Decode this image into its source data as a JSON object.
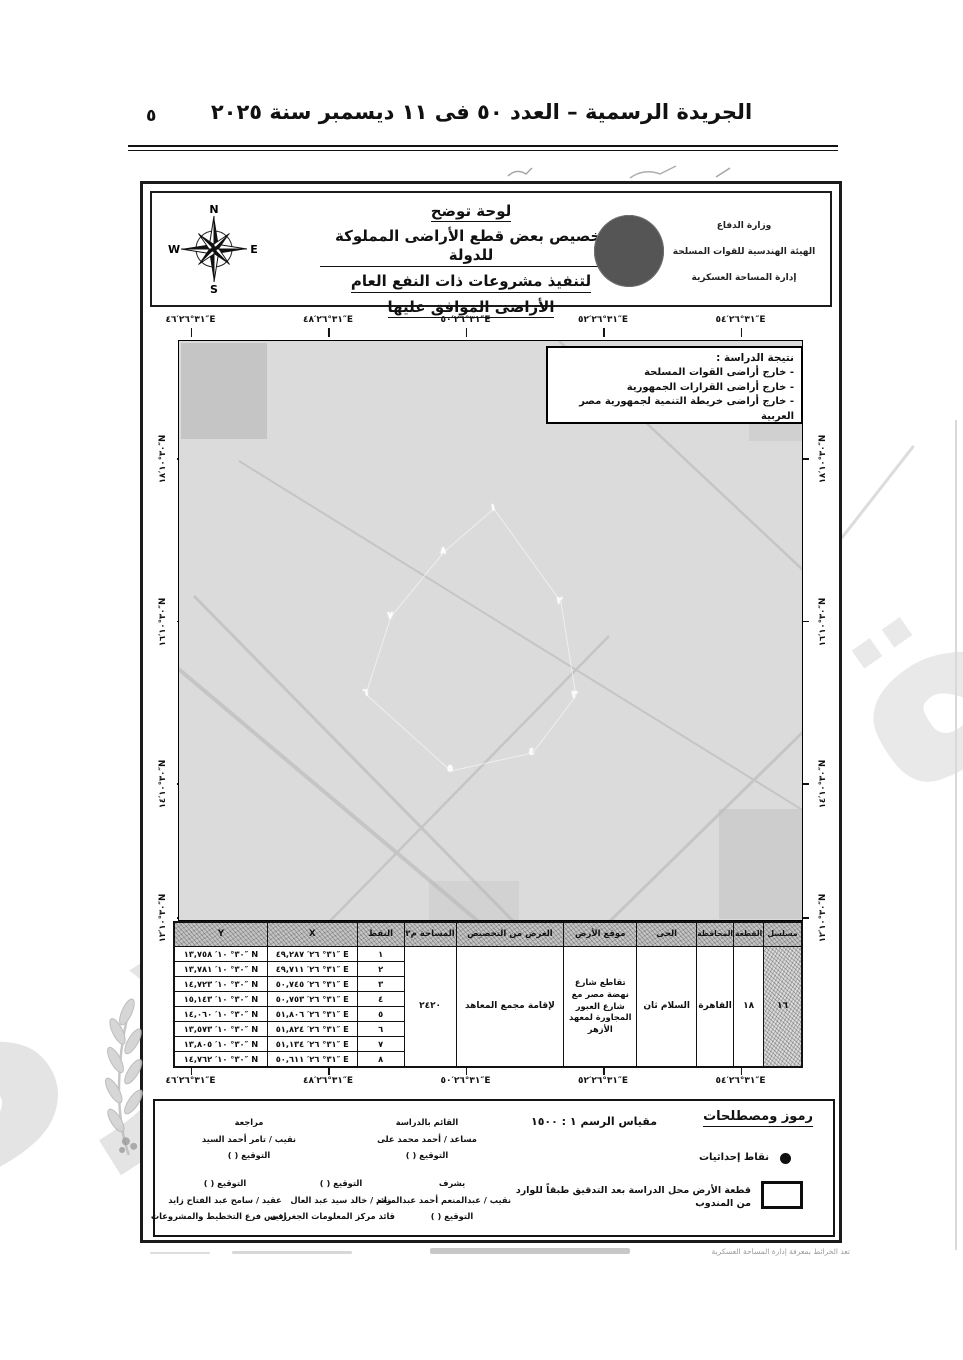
{
  "gazette": {
    "header_title": "الجريدة الرسمية – العدد ٥٠ فى ١١ ديسمبر سنة ٢٠٢٥",
    "page_number": "٥",
    "print_note": "تعد الخرائط بمعرفة إدارة المساحة العسكرية"
  },
  "plate": {
    "compass": {
      "n": "N",
      "s": "S",
      "e": "E",
      "w": "W"
    },
    "title_lines": [
      "لوحة توضح",
      "تخصيص بعض قطع الأراضى المملوكة للدولة",
      "لتنفيذ مشروعات ذات النفع العام",
      "الأراضى الموافق عليها"
    ],
    "agency_lines": [
      "وزارة الدفاع",
      "الهيئة الهندسية للقوات المسلحة",
      "إدارة المساحة العسكرية"
    ],
    "study_note": {
      "title": "نتيجة الدراسة :",
      "items": [
        {
          "text": "- خارج أراضى القوات المسلحة"
        },
        {
          "text": "- خارج أراضى القرارات الجمهورية"
        },
        {
          "text": "- خارج أراضى خريطة التنمية لجمهورية مصر العربية"
        }
      ]
    },
    "map": {
      "top_labels": [
        {
          "text": "٣١°٢٦′٤٦″E",
          "x": 2
        },
        {
          "text": "٣١°٢٦′٤٨″E",
          "x": 24
        },
        {
          "text": "٣١°٢٦′٥٠″E",
          "x": 46
        },
        {
          "text": "٣١°٢٦′٥٢″E",
          "x": 68
        },
        {
          "text": "٣١°٢٦′٥٤″E",
          "x": 90
        }
      ],
      "bottom_labels": [
        {
          "text": "٣١°٢٦′٤٦″E",
          "x": 2
        },
        {
          "text": "٣١°٢٦′٤٨″E",
          "x": 24
        },
        {
          "text": "٣١°٢٦′٥٠″E",
          "x": 46
        },
        {
          "text": "٣١°٢٦′٥٢″E",
          "x": 68
        },
        {
          "text": "٣١°٢٦′٥٤″E",
          "x": 90
        }
      ],
      "left_labels": [
        {
          "text": "٣٠°١٠′١٨″N",
          "y": 20.5
        },
        {
          "text": "٣٠°١٠′١٦″N",
          "y": 48.5
        },
        {
          "text": "٣٠°١٠′١٤″N",
          "y": 76.5
        },
        {
          "text": "٣٠°١٠′١٢″N",
          "y": 99.5
        }
      ],
      "right_labels": [
        {
          "text": "٣٠°١٠′١٨″N",
          "y": 20.5
        },
        {
          "text": "٣٠°١٠′١٦″N",
          "y": 48.5
        },
        {
          "text": "٣٠°١٠′١٤″N",
          "y": 76.5
        },
        {
          "text": "٣٠°١٠′١٢″N",
          "y": 99.5
        }
      ],
      "points": [
        {
          "label": "١",
          "x": 50.4,
          "y": 28.9
        },
        {
          "label": "٢",
          "x": 61.1,
          "y": 44.9
        },
        {
          "label": "٣",
          "x": 63.5,
          "y": 61.1
        },
        {
          "label": "٤",
          "x": 56.6,
          "y": 70.9
        },
        {
          "label": "٥",
          "x": 43.5,
          "y": 74.0
        },
        {
          "label": "٦",
          "x": 29.9,
          "y": 60.8
        },
        {
          "label": "٧",
          "x": 33.9,
          "y": 47.5
        },
        {
          "label": "٨",
          "x": 42.4,
          "y": 36.3
        }
      ]
    },
    "table": {
      "headers": {
        "y": "Y",
        "x": "X",
        "pt": "النقط",
        "area": "المساحة م٢",
        "purpose": "الغرض من التخصيص",
        "location": "موقع الأرض",
        "district": "الحى",
        "gov": "المحافظة",
        "plot": "القطعة",
        "serial": "مسلسل"
      },
      "rows": [
        {
          "n": "١",
          "x": "٣١° ٢٦′ ٤٩,٢٨٧″ E",
          "y": "٣٠° ١٠′ ١٣,٧٥٨″ N"
        },
        {
          "n": "٢",
          "x": "٣١° ٢٦′ ٤٩,٧١١″ E",
          "y": "٣٠° ١٠′ ١٣,٧٨١″ N"
        },
        {
          "n": "٣",
          "x": "٣١° ٢٦′ ٥٠,٧٤٥″ E",
          "y": "٣٠° ١٠′ ١٤,٧٢٣″ N"
        },
        {
          "n": "٤",
          "x": "٣١° ٢٦′ ٥٠,٧٥٣″ E",
          "y": "٣٠° ١٠′ ١٥,١٤٣″ N"
        },
        {
          "n": "٥",
          "x": "٣١° ٢٦′ ٥١,٨٠٦″ E",
          "y": "٣٠° ١٠′ ١٤,٠٦٠″ N"
        },
        {
          "n": "٦",
          "x": "٣١° ٢٦′ ٥١,٨٢٤″ E",
          "y": "٣٠° ١٠′ ١٣,٥٧٣″ N"
        },
        {
          "n": "٧",
          "x": "٣١° ٢٦′ ٥١,١٣٤″ E",
          "y": "٣٠° ١٠′ ١٣,٨٠٥″ N"
        },
        {
          "n": "٨",
          "x": "٣١° ٢٦′ ٥٠,٦١١″ E",
          "y": "٣٠° ١٠′ ١٤,٧٦٢″ N"
        }
      ],
      "record": {
        "area": "٢٤٢٠",
        "purpose": "لإقامة مجمع المعاهد",
        "location": "تقاطع شارع نهضة مصر مع شارع العبور المجاورة لمعهد الأزهر",
        "district": "السلام ثان",
        "gov": "القاهرة",
        "plot": "١٨",
        "serial": "١٦"
      }
    },
    "legend": {
      "heading": "رموز ومصطلحات",
      "dot_label": "نقاط إحداثيات",
      "rect_label": "قطعة الأرض محل الدراسة بعد التدقيق طبقاً للوارد من المندوب",
      "scale_text": "مقياس الرسم    ١ : ١٥٠٠"
    },
    "signatures": [
      {
        "top": "القائم بالدراسة",
        "mid": "مساعد / أحمد محمد على",
        "bot": "التوقيع (        )"
      },
      {
        "top": "مراجعة",
        "mid": "نقيب / تامر أحمد السيد",
        "bot": "التوقيع (        )"
      },
      {
        "top": "يشرف",
        "mid": "نقيب / عبدالمنعم أحمد عبدالمنعم",
        "bot": "التوقيع (        )"
      },
      {
        "top": "التوقيع (        )",
        "mid": "رائد / خالد سيد عبد العال",
        "bot": "قائد مركز المعلومات الجغرافى"
      },
      {
        "top": "التوقيع (        )",
        "mid": "عقيد / سامح عبد الفتاح زايد",
        "bot": "رئيس فرع التخطيط والمشروعات"
      }
    ],
    "watermark_text": "صورة"
  }
}
